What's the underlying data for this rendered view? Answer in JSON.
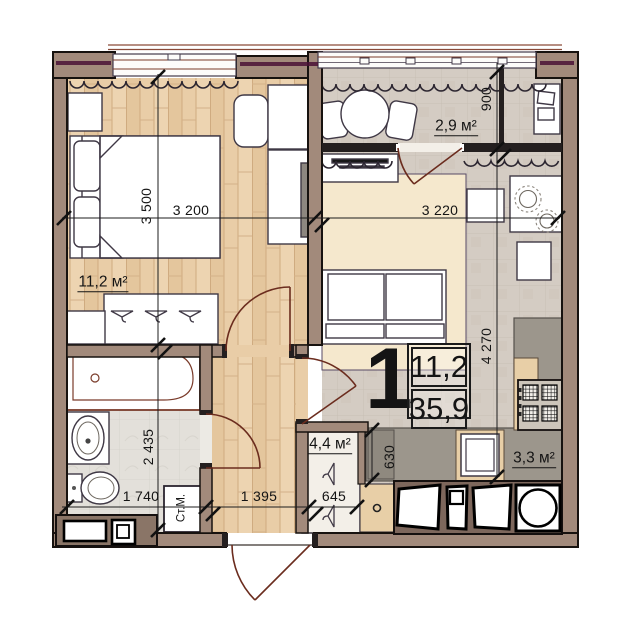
{
  "plan": {
    "unit": {
      "type": "1",
      "living_area": "11,2",
      "total_area": "35,9"
    },
    "areas": {
      "bedroom": "11,2 м²",
      "balcony": "2,9 м²",
      "closet": "4,4 м²",
      "kitchen": "3,3 м²"
    },
    "dimensions": {
      "bedroom_h": "3 500",
      "bedroom_w": "3 200",
      "living_w": "3 220",
      "balcony_h": "900",
      "kitchen_h": "4 270",
      "bath_h": "2 435",
      "bath_w": "1 740",
      "hall_w": "1 395",
      "closet_w": "645",
      "counter_d": "630"
    },
    "appliances": {
      "washing_machine": "Ст.М."
    },
    "colors": {
      "wall": "#a28a7b",
      "wall_dark": "#241f1f",
      "wood_floor": "#e9cda7",
      "tile_floor": "#d4ccc3",
      "bath_floor": "#e3e0da",
      "rug": "#f5e8cd",
      "accent_purple": "#4a1136",
      "door_arc": "#6b2c1e",
      "counter_gray": "#9c968c",
      "cabinet_tan": "#e8cfa7"
    }
  }
}
